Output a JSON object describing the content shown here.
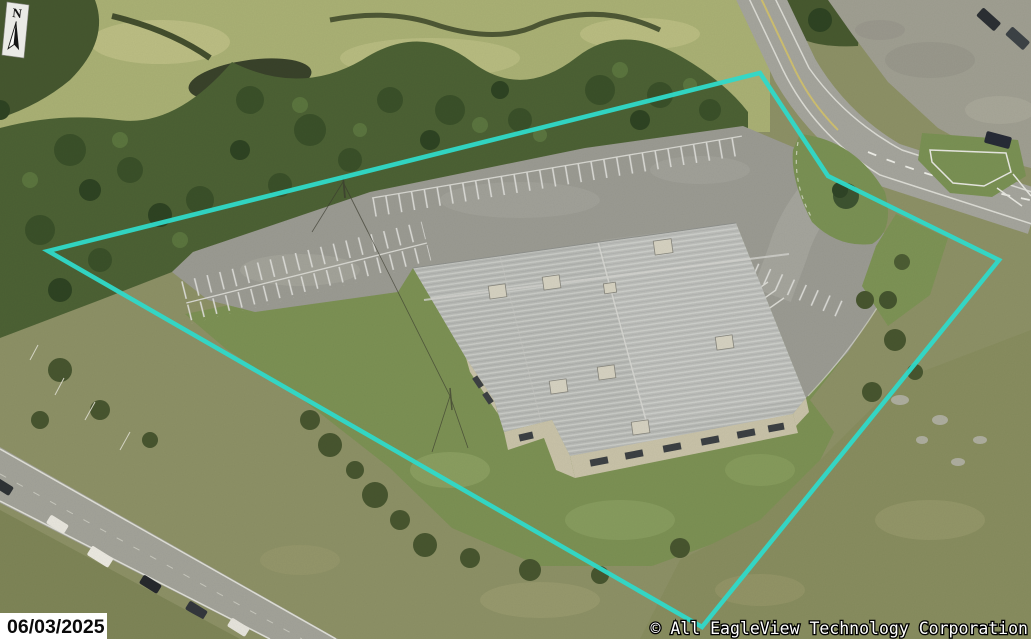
{
  "overlay": {
    "north_label": "N",
    "date_stamp": "06/03/2025",
    "copyright": "© All EagleView Technology Corporation",
    "text_color": "#ffffff"
  },
  "boundary": {
    "color": "#2FD9C9",
    "stroke_width": "4.5",
    "points": "48,251 760,73 828,176 999,260 702,627"
  }
}
